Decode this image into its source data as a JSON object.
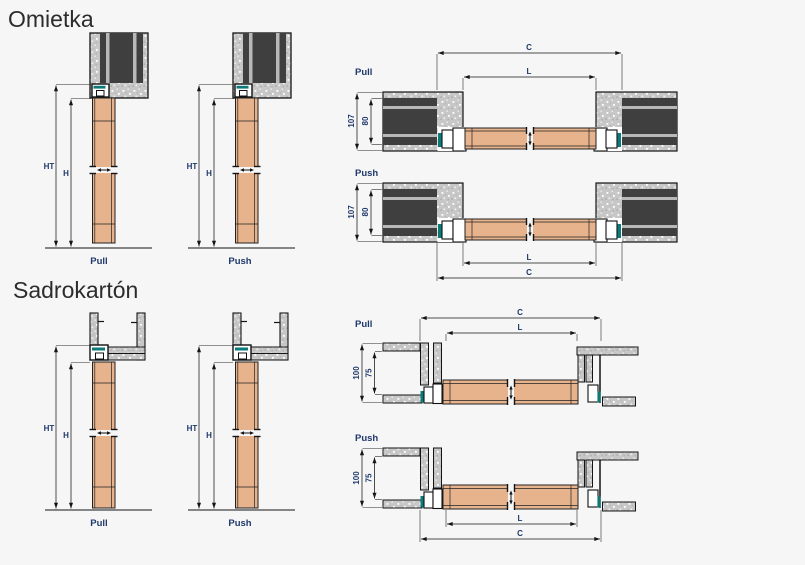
{
  "colors": {
    "background": "#f5f6f5",
    "door_leaf": "#e7b38d",
    "plaster_fill": "#c7c7c7",
    "wall_core": "#3f3f3f",
    "seal_teal": "#0c7a78",
    "dimension_text": "#20386b",
    "line": "#141414",
    "title_text": "#2c2c2c"
  },
  "omietka": {
    "title": "Omietka",
    "vertical": {
      "pull": "Pull",
      "push": "Push",
      "ht": "HT",
      "h": "H"
    },
    "horizontal": {
      "pull": "Pull",
      "push": "Push",
      "c": "C",
      "l": "L",
      "depth_total": "107",
      "depth_frame": "80"
    }
  },
  "sadrokarton": {
    "title": "Sadrokartón",
    "vertical": {
      "pull": "Pull",
      "push": "Push",
      "ht": "HT",
      "h": "H"
    },
    "horizontal": {
      "pull": "Pull",
      "push": "Push",
      "c": "C",
      "l": "L",
      "depth_total": "100",
      "depth_frame": "75"
    }
  }
}
